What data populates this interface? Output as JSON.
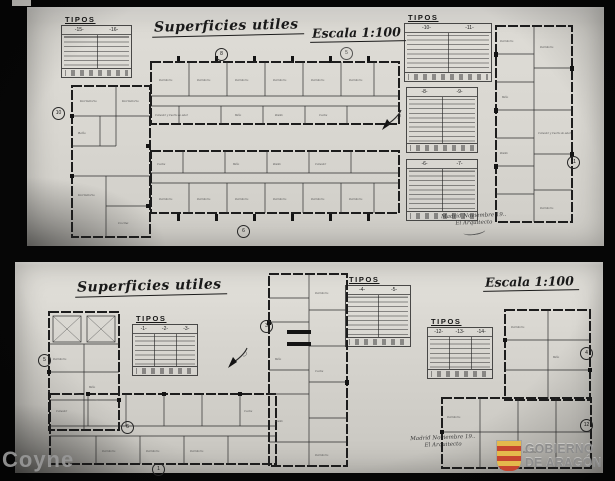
{
  "watermarks": {
    "left": "Coyne",
    "right_line1": "GOBIERNO",
    "right_line2": "DE ARAGÓN"
  },
  "colors": {
    "paper": "#d9d7d1",
    "ink": "#1d1d1d",
    "shield_red": "#c6452f",
    "shield_yellow": "#e4b94c"
  },
  "rooms": {
    "dorm": "Dormitorio",
    "bano": "Baño",
    "pasillo": "Pasillo",
    "cocina": "Cocina",
    "comedor": "Comedor y Cuarto de estar",
    "comedor2": "Comedor"
  },
  "sheet_top": {
    "title": "Superficies utiles",
    "scale": "Escala 1:100",
    "sig_line1": "Madrid Noviembre 19..",
    "sig_line2": "El Arquitecto",
    "tables": [
      {
        "title": "TIPOS",
        "cols": [
          "-15-",
          "-16-"
        ]
      },
      {
        "title": "TIPOS",
        "cols": [
          "-10-",
          "-11-"
        ]
      },
      {
        "cols": [
          "-8-",
          "-9-"
        ]
      },
      {
        "cols": [
          "-6-",
          "-7-"
        ]
      }
    ],
    "circles": [
      "10",
      "8",
      "5",
      "6",
      "11"
    ]
  },
  "sheet_bottom": {
    "title": "Superficies utiles",
    "scale": "Escala 1:100",
    "sig_line1": "Madrid Noviembre 19..",
    "sig_line2": "El Arquitecto",
    "tables": [
      {
        "title": "TIPOS",
        "cols": [
          "-1-",
          "-2-",
          "-3-"
        ]
      },
      {
        "title": "TIPOS",
        "cols": [
          "-4-",
          "-5-"
        ]
      },
      {
        "title": "TIPOS",
        "cols": [
          "-12-",
          "-13-",
          "-14-"
        ]
      }
    ],
    "circles": [
      "5",
      "3",
      "4",
      "6",
      "1",
      "12"
    ]
  }
}
